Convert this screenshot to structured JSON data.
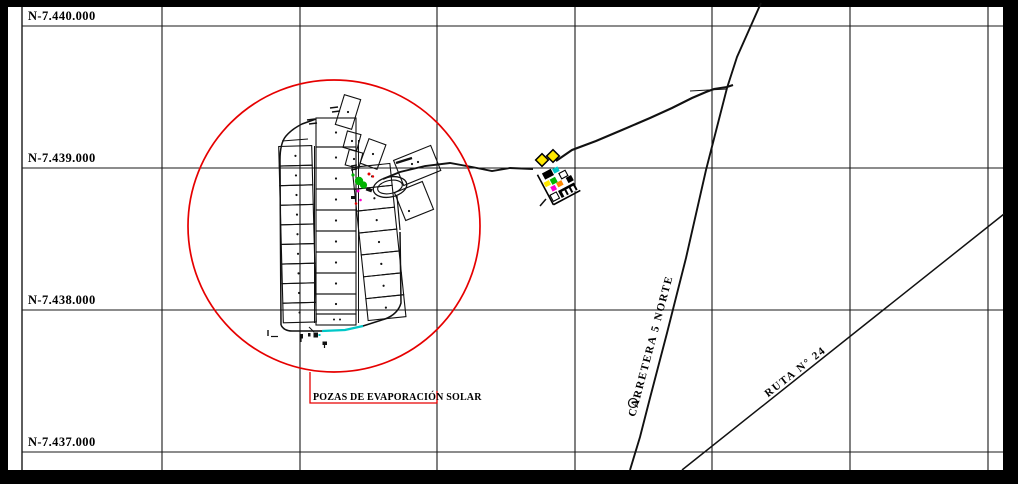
{
  "app": {
    "type": "cad-site-plan"
  },
  "grid": {
    "northing_labels": [
      "N-7.440.000",
      "N-7.439.000",
      "N-7.438.000",
      "N-7.437.000"
    ]
  },
  "annotations": {
    "pond_label": "POZAS DE EVAPORACIÓN SOLAR",
    "carretera_label": "CARRETERA 5 NORTE",
    "ruta_label": "RUTA N° 24"
  },
  "colors": {
    "background": "#000000",
    "paper": "#ffffff",
    "line": "#111111",
    "highlight_red": "#e60000",
    "pond_cyan": "#00c8c8",
    "facility_green": "#00b300",
    "facility_yellow": "#ffe800",
    "facility_magenta": "#ff00cc",
    "facility_orange": "#ff8800"
  }
}
